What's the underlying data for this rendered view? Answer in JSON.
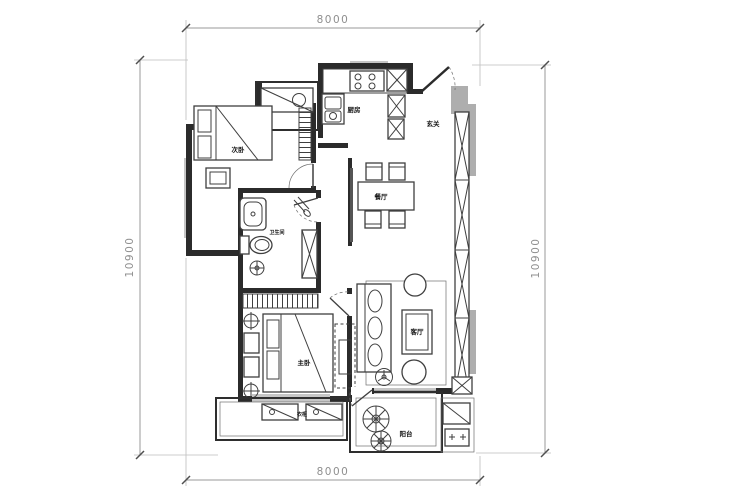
{
  "plan": {
    "dims": {
      "top": "8000",
      "bottom": "8000",
      "left": "10900",
      "right": "10900"
    },
    "rooms": {
      "secondary_bedroom": "次卧",
      "kitchen": "厨房",
      "foyer": "玄关",
      "dining": "餐厅",
      "bathroom": "卫生间",
      "living": "客厅",
      "master_bedroom": "主卧",
      "balcony": "阳台",
      "wardrobe": "衣柜"
    },
    "colors": {
      "wall": "#2b2b2b",
      "line": "#3f3f3f",
      "window_gray": "#c6c6c6",
      "shade_gray": "#aeaeae",
      "dimension": "#8f8f8f",
      "label": "#141414",
      "background": "#ffffff"
    }
  }
}
